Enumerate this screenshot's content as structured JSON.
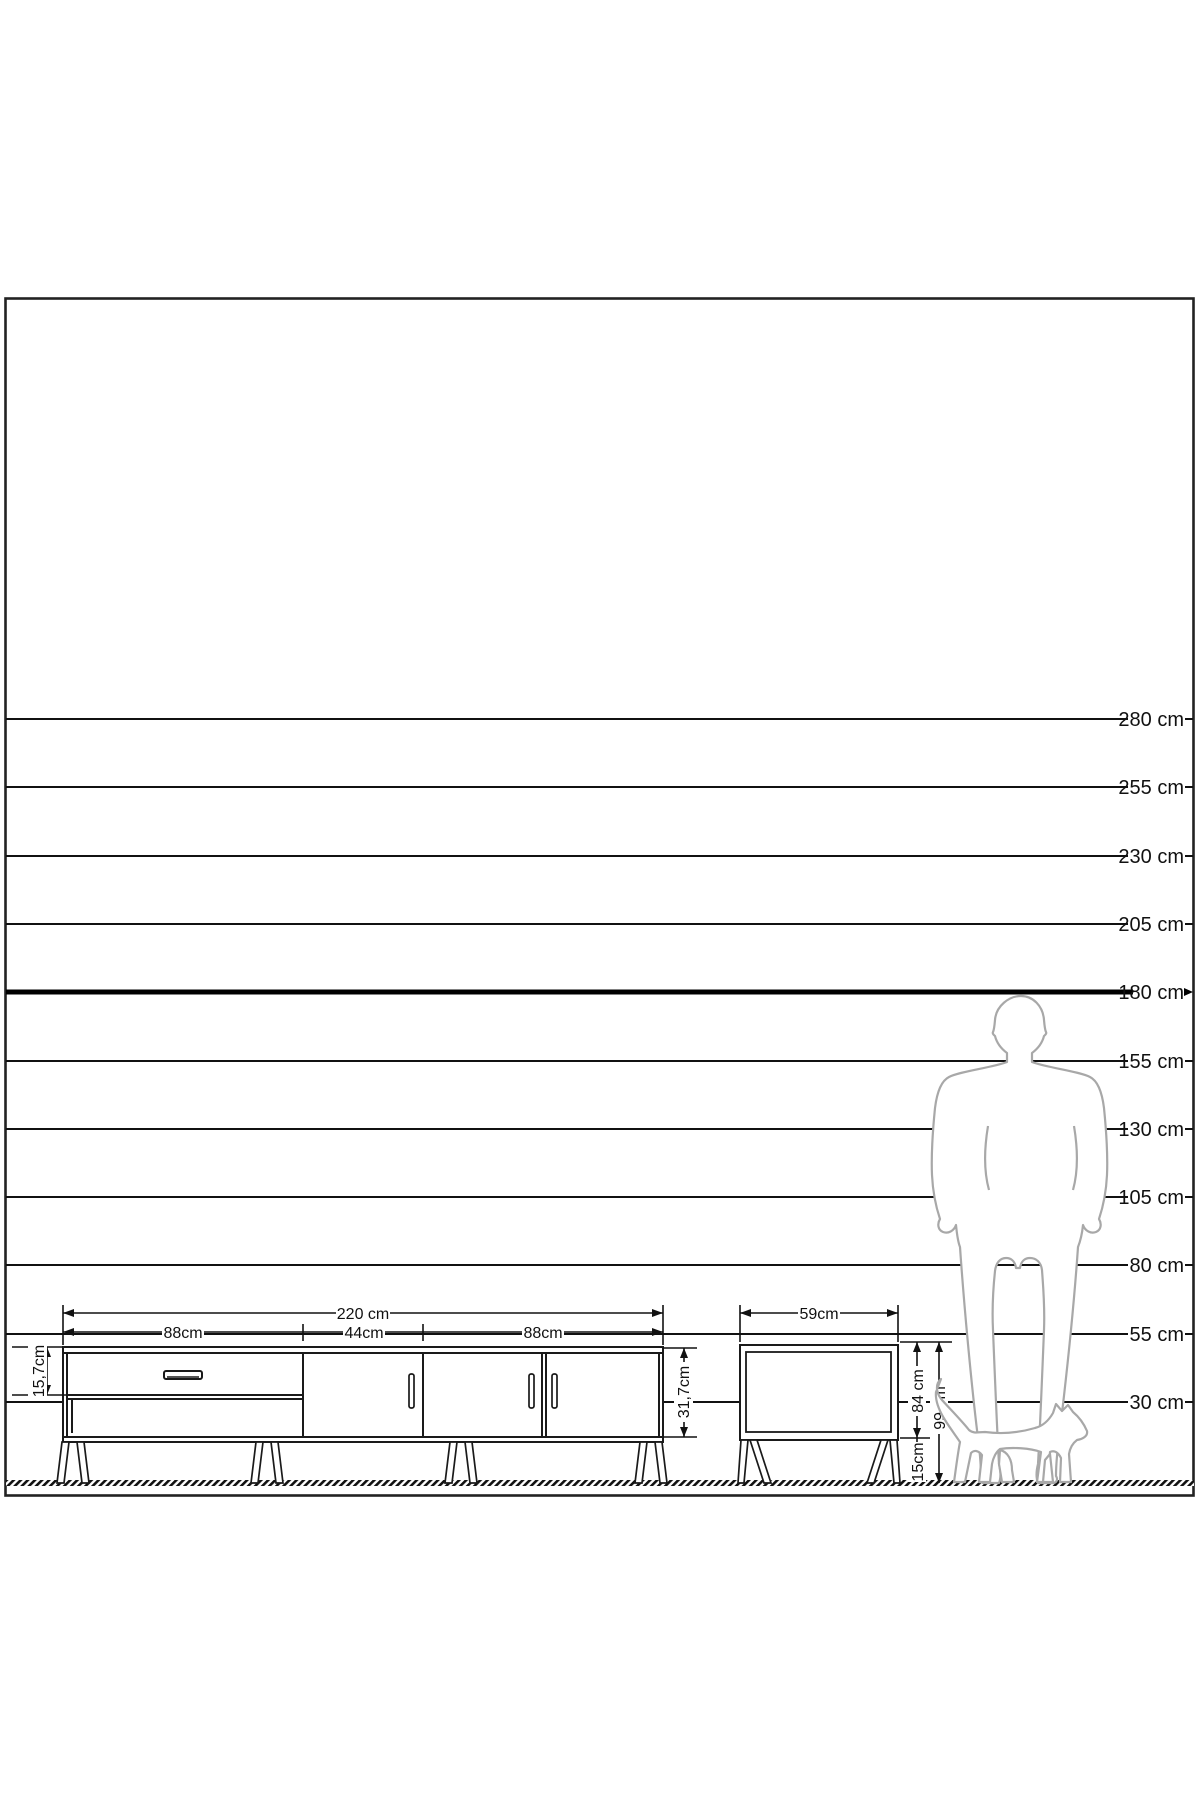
{
  "diagram": {
    "type": "furniture-dimension-diagram",
    "unit": "cm"
  },
  "colors": {
    "background": "#ffffff",
    "line": "#1a1a1a",
    "bold_line": "#000000",
    "figure_outline": "#a8a8a8"
  },
  "scale": {
    "unit": "cm",
    "bold_value": 180,
    "lines": [
      {
        "label": "280 cm",
        "value": 280
      },
      {
        "label": "255 cm",
        "value": 255
      },
      {
        "label": "230 cm",
        "value": 230
      },
      {
        "label": "205 cm",
        "value": 205
      },
      {
        "label": "180 cm",
        "value": 180
      },
      {
        "label": "155 cm",
        "value": 155
      },
      {
        "label": "130 cm",
        "value": 130
      },
      {
        "label": "105 cm",
        "value": 105
      },
      {
        "label": "80 cm",
        "value": 80
      },
      {
        "label": "55 cm",
        "value": 55
      },
      {
        "label": "30 cm",
        "value": 30
      }
    ]
  },
  "tv_stand": {
    "total_width": "220 cm",
    "sections": [
      "88cm",
      "44cm",
      "88cm"
    ],
    "drawer_front_height": "15,7cm",
    "body_height": "31,7cm"
  },
  "side_table": {
    "width": "59cm",
    "body_height": "84 cm",
    "total_height": "99 cm",
    "leg_height": "15cm"
  }
}
